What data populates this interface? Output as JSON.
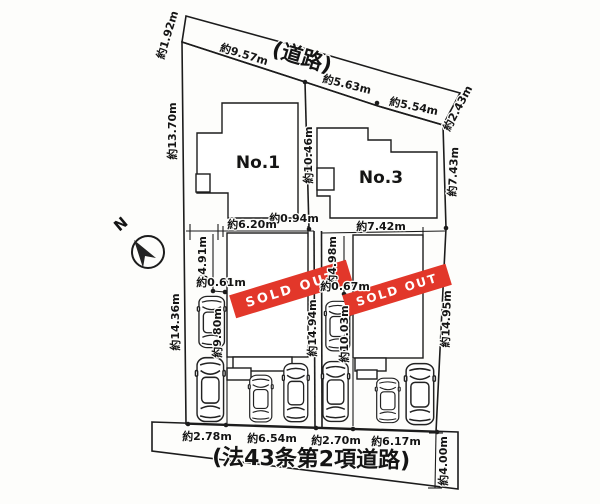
{
  "compass": {
    "north_label": "N"
  },
  "roads": {
    "top_label": "(道路)",
    "bottom_label": "(法43条第2項道路)"
  },
  "houses": {
    "no1_label": "No.1",
    "no3_label": "No.3"
  },
  "banner": {
    "sold_out_label": "SOLD OUT"
  },
  "dims": {
    "top_edge_left": "約1.92m",
    "road_seg1": "約9.57m",
    "road_seg2": "約5.63m",
    "road_seg3": "約5.54m",
    "top_edge_right": "約2.43m",
    "left_upper": "約13.70m",
    "left_lower": "約14.36m",
    "center_upper": "約10.46m",
    "center_gap": "約0.94m",
    "center_lower": "約14.94m",
    "right_upper": "約7.43m",
    "right_lower": "約14.95m",
    "lot1_width": "約6.20m",
    "lot1_depth": "約4.91m",
    "lot1_offset": "約0.61m",
    "lot1_drive": "約9.80m",
    "lot2_width": "約7.42m",
    "lot2_depth": "約4.98m",
    "lot2_offset": "約0.67m",
    "lot2_drive": "約10.03m",
    "bottom_seg1": "約2.78m",
    "bottom_seg2": "約6.54m",
    "bottom_seg3": "約2.70m",
    "bottom_seg4": "約6.17m",
    "bottom_road_width": "約4.00m"
  },
  "colors": {
    "road_fill": "#e8eae1",
    "banner_red": "#e2372a",
    "line": "#1c1c1c",
    "paper": "#fdfdfb"
  }
}
